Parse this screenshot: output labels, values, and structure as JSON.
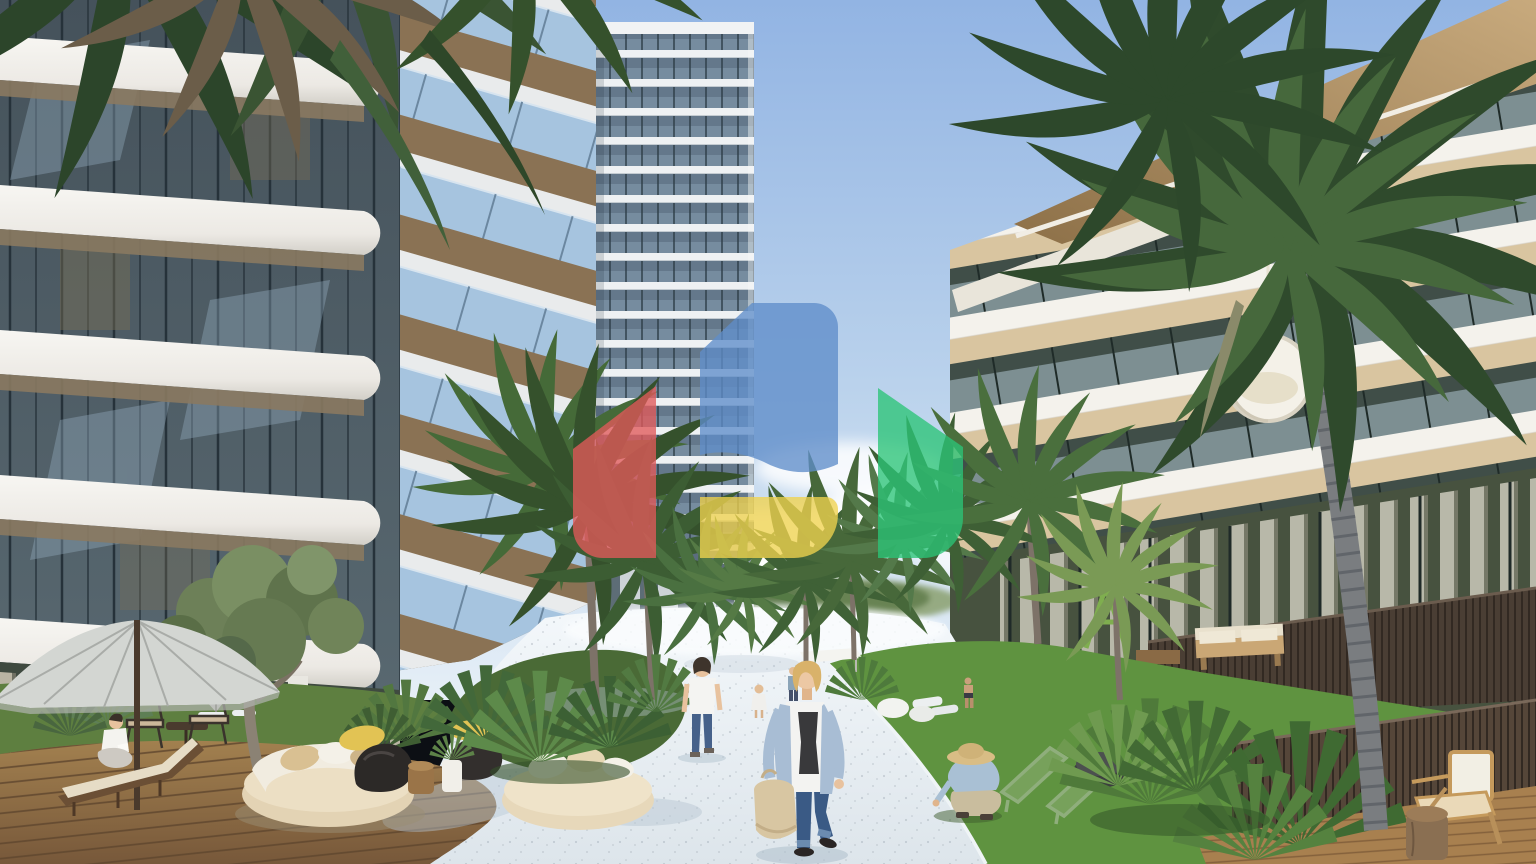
{
  "meta": {
    "kind": "architectural-rendering",
    "subject": "Tropical residential complex courtyard: white terrazzo walkway between three modern apartment buildings, palm trees, garden lounges and pedestrians, with a four-color real-estate logo watermark",
    "width_px": 1536,
    "height_px": 864
  },
  "watermark": {
    "name": "real-estate-logo-watermark",
    "opacity": 0.78,
    "colors": {
      "red": "#e25a5a",
      "blue": "#5f8dc9",
      "yellow": "#f0d24e",
      "green": "#2cc477"
    }
  },
  "palette": {
    "sky_top": "#92b4e3",
    "sky_mid": "#bad2ec",
    "sky_horizon": "#e6eff7",
    "cloud": "#ffffff",
    "path_light": "#f4f8fb",
    "path_shade": "#dde5eb",
    "lawn_left": "#5e7f40",
    "lawn_right": "#5f9340",
    "deck_top": "#a2804f",
    "deck_bottom": "#77583a",
    "tower_glass": "#64788b",
    "tower_slab": "#eef1f3",
    "left_glass": "#49565e",
    "ceiling_tan": "#8a7960",
    "wing_glass": "#a6c4df",
    "right_wall_cream": "#eeebe0",
    "right_ceiling": "#d9c5a0",
    "roof_light": "#c9ab7e",
    "roof_dark": "#8d7048",
    "fence_wood": "#4a3e34",
    "palm_dark": "#2f4a2c",
    "palm_mid": "#3f6136",
    "palm_light": "#5d8248",
    "trunk_gray": "#7a7d80",
    "umbrella_gray": "#d3d6d2",
    "daybed_cream": "#e3d3b4",
    "pillow_yellow": "#e2c354",
    "beanbag_charcoal": "#2c2927"
  },
  "scene": {
    "buildings": [
      {
        "name": "left-residential-block",
        "style": "curved white balcony bands over dark glass",
        "position": "left"
      },
      {
        "name": "central-high-rise-tower",
        "floors_visible": 21,
        "position": "center"
      },
      {
        "name": "right-residential-block",
        "style": "slanted roof overhang, wood ceilings, glass balconies",
        "position": "right"
      }
    ],
    "people": [
      {
        "name": "woman-walking-foreground",
        "details": "blonde, light blue cardigan, white printed top, blue jeans, beige tote bag, black flats"
      },
      {
        "name": "man-walking-away",
        "details": "white t-shirt, blue jeans"
      },
      {
        "name": "person-crouching-gardening",
        "details": "straw hat, light blue shirt, khaki trousers"
      },
      {
        "name": "person-seated-reading",
        "details": "white top, seated cross-legged beside chaise"
      },
      {
        "name": "child-distant",
        "details": "light dress, on walkway"
      },
      {
        "name": "pedestrian-distant",
        "details": "small figure mid-walkway"
      },
      {
        "name": "pedestrian-near-right-building",
        "details": "small figure in dark swimwear"
      }
    ],
    "vegetation": [
      "overhanging-palm-fronds-top-left",
      "olive-tree",
      "palm-cluster-center",
      "palm-row-along-walkway",
      "large-foreground-palm-right",
      "fan-palmetto-shrubs",
      "lawns"
    ],
    "furniture": [
      "gray-patio-umbrella",
      "wooden-chaise-lounge",
      "bistro-chairs-with-side-table",
      "round-daybed-with-pillows",
      "second-round-daybed",
      "black-bean-bags",
      "yellow-pillows",
      "log-side-table",
      "white-planter",
      "white-garden-poufs",
      "green-wire-loungers",
      "dark-pouf",
      "terrace-wood-sofa",
      "hanging-egg-chair",
      "green-swing-frame",
      "cane-armchair",
      "log-stool",
      "white-sun-loungers",
      "small-parasol-distant",
      "white-canopy-distant"
    ],
    "ground": [
      "white-terrazzo-walkway",
      "wooden-deck-left",
      "wooden-deck-right",
      "curved-lawn-right",
      "garden-bed-center"
    ]
  }
}
